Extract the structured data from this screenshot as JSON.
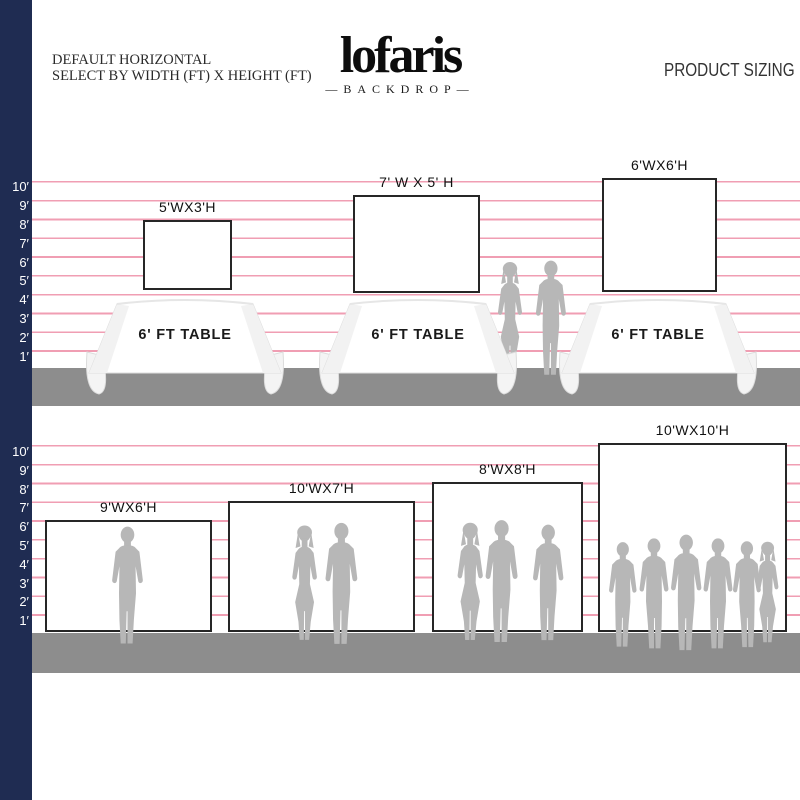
{
  "header": {
    "tagline_line1": "DEFAULT HORIZONTAL",
    "tagline_line2": "SELECT BY WIDTH (FT) X HEIGHT (FT)",
    "brand": "lofaris",
    "brand_sub": "—BACKDROP—",
    "page_title": "PRODUCT SIZING"
  },
  "ruler_labels": [
    "10′",
    "9′",
    "8′",
    "7′",
    "6′",
    "5′",
    "4′",
    "3′",
    "2′",
    "1′"
  ],
  "top_row": {
    "backdrops": [
      {
        "label": "5'WX3'H"
      },
      {
        "label": "7' W X 5' H"
      },
      {
        "label": "6'WX6'H"
      }
    ],
    "table_label": "6' FT TABLE"
  },
  "bottom_row": {
    "backdrops": [
      {
        "label": "9'WX6'H"
      },
      {
        "label": "10'WX7'H"
      },
      {
        "label": "8'WX8'H"
      },
      {
        "label": "10'WX10'H"
      }
    ]
  },
  "colors": {
    "navy": "#1f2c52",
    "gridline_pink": "#f09eb3",
    "floor_gray": "#8d8d8d",
    "silhouette_gray": "#b7b7b7"
  }
}
